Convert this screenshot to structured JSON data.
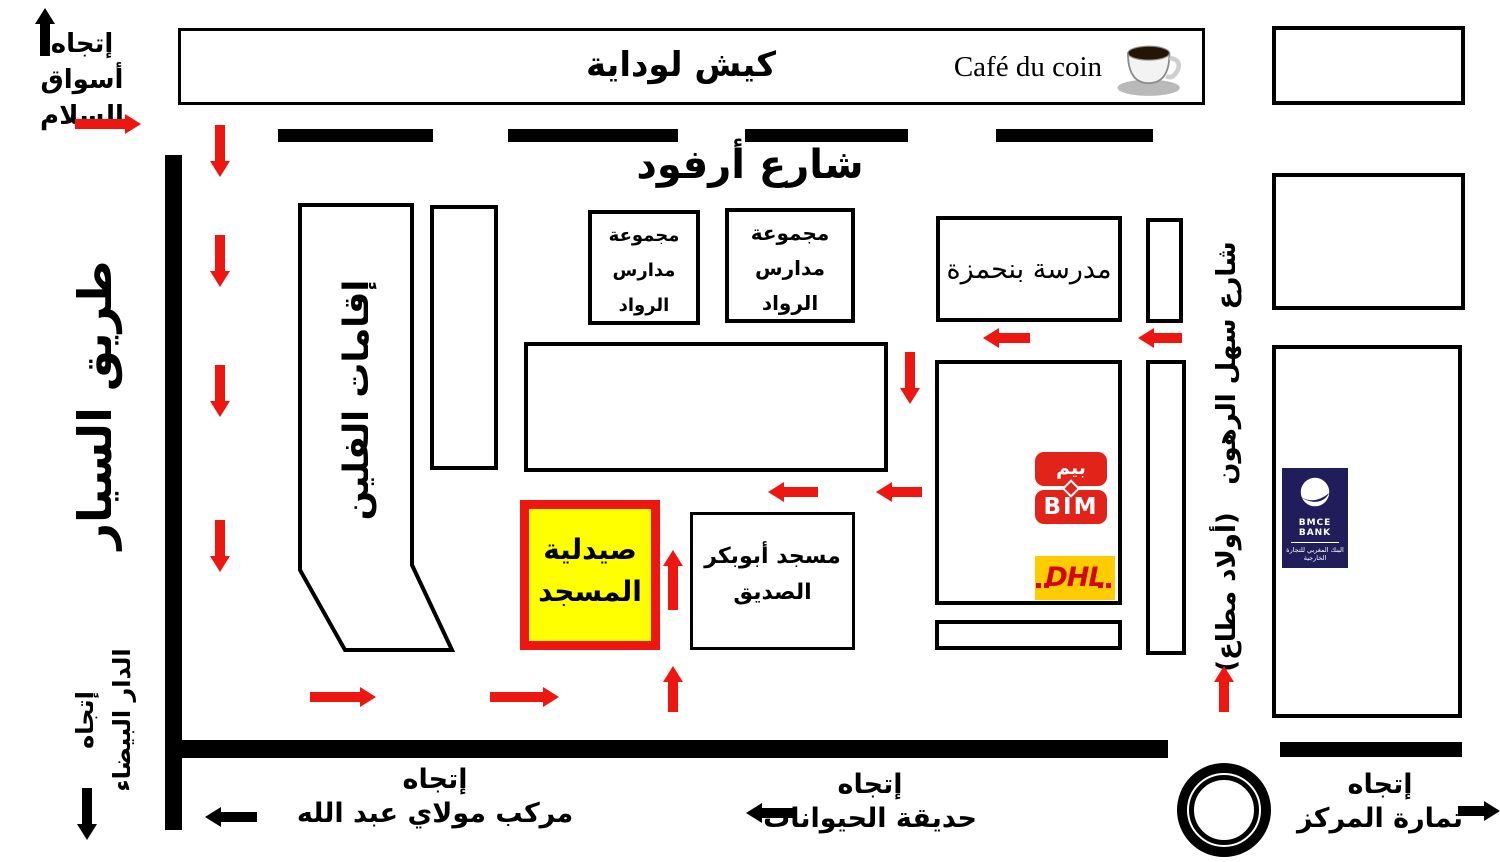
{
  "colors": {
    "arrow_red": "#ee1611",
    "pharmacy_fill": "#ffff00",
    "pharmacy_border": "#ee1611",
    "bim_red": "#e2231a",
    "dhl_yellow": "#ffcc00",
    "dhl_red": "#d40511",
    "bmce_navy": "#201d5a"
  },
  "top_strip": {
    "kiosk_label": "كيش لوداية",
    "cafe_label": "Café du coin"
  },
  "streets": {
    "arfoud": "شارع أرفود",
    "highway": "طريق السيار",
    "sahl_rhoune": "شارع سهل الرهون",
    "oulad_mtaa": "(أولاد مطاع)"
  },
  "buildings": {
    "residences": "إقامات الفلين",
    "school_group": {
      "line1": "مجموعة",
      "line2": "مدارس",
      "line3": "الرواد"
    },
    "benhamza": "مدرسة بنحمزة",
    "pharmacy": {
      "line1": "صيدلية",
      "line2": "المسجد"
    },
    "mosque": {
      "line1": "مسجد أبوبكر",
      "line2": "الصديق"
    }
  },
  "logos": {
    "bim": {
      "arabic": "بيم",
      "latin": "BIM"
    },
    "dhl": "DHL",
    "bmce": {
      "name": "BMCE BANK",
      "arabic": "البنك المغربي للتجارة الخارجية"
    }
  },
  "directions": {
    "souk_salam": {
      "line1": "إتجاه",
      "line2": "أسواق السلام"
    },
    "casablanca": {
      "line1": "إتجاه",
      "line2": "الدار البيضاء"
    },
    "moulay_abdallah": {
      "line1": "إتجاه",
      "line2": "مركب مولاي عبد الله"
    },
    "zoo": {
      "line1": "إتجاه",
      "line2": "حديقة الحيوانات"
    },
    "temara": {
      "line1": "إتجاه",
      "line2": "تمارة المركز"
    }
  }
}
